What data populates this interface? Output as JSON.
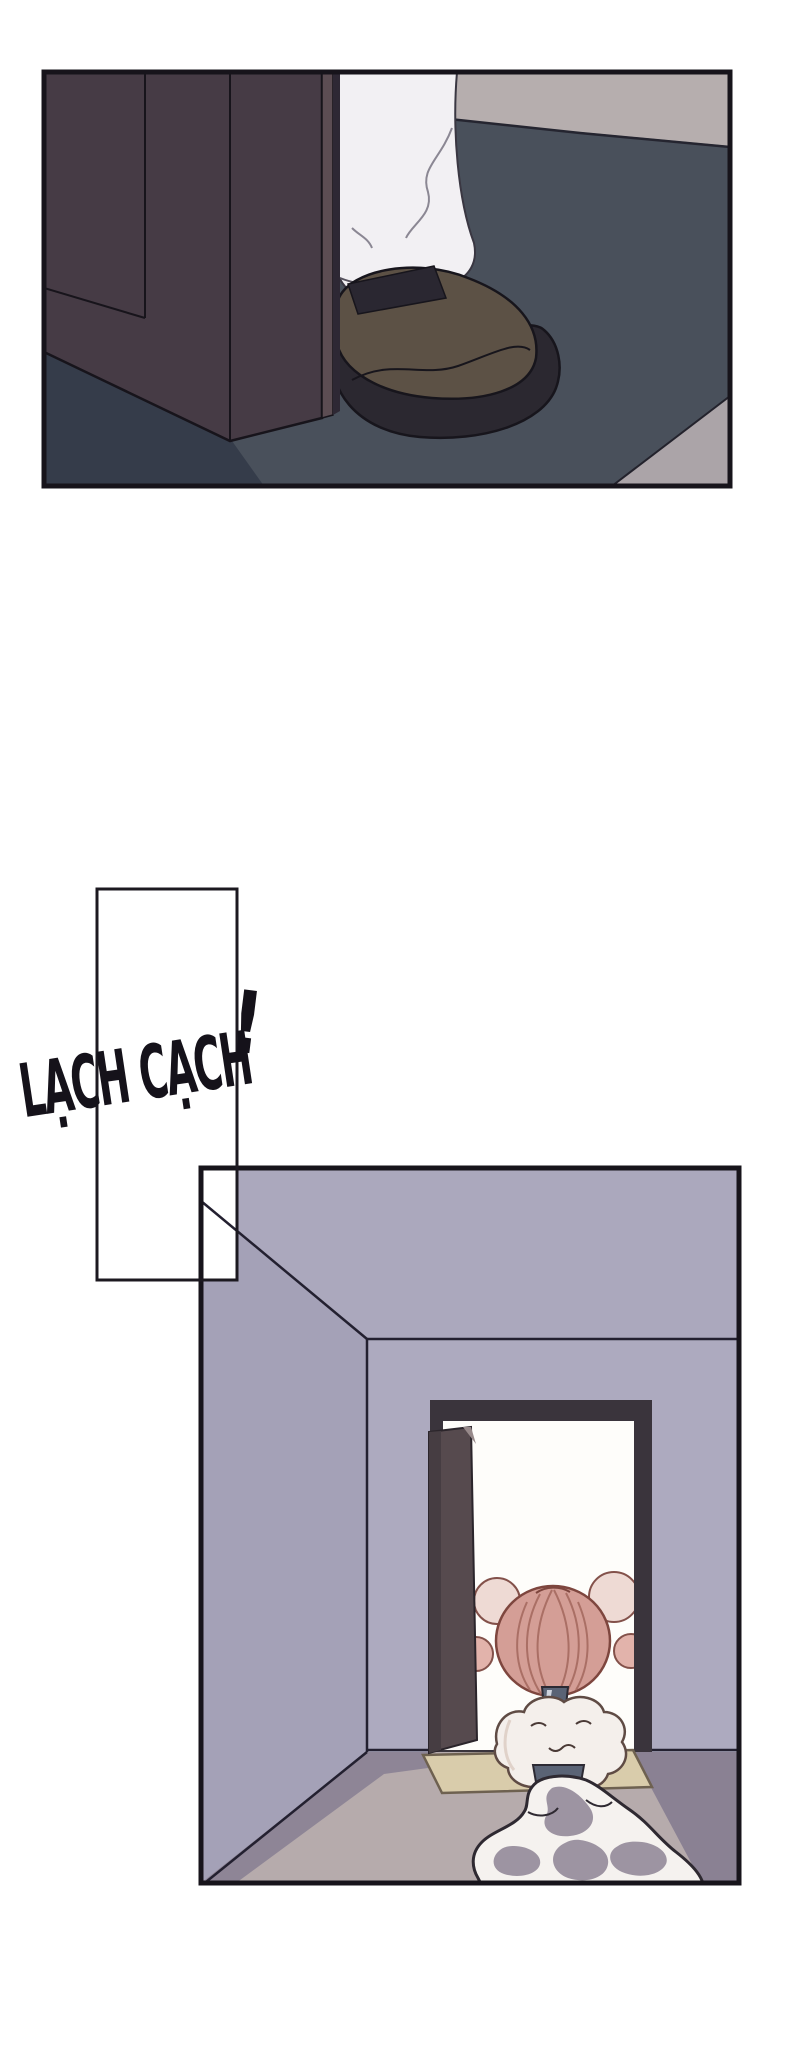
{
  "page": {
    "kind": "comic-page",
    "sfx": {
      "text": "LẠCH CẠCH",
      "bang": "!"
    }
  },
  "panels": {
    "top": {
      "alt": "Close-up of a shoe and white pant leg stepping past a dark wardrobe door onto a dark mat"
    },
    "speech": {
      "alt": "Empty tall rectangular panel behind the sound-effect text"
    },
    "bottom": {
      "alt": "Room interior with an open doorway; a small pink-haired figure sits in the doorway with a liquid trail flowing onto the floor"
    }
  },
  "palette": {
    "ink": "#17141b",
    "line": "#232030",
    "top_bg": "#b6aeae",
    "top_mat": "#49505b",
    "top_mat_dark": "#353c4a",
    "top_corner": "#aba4a8",
    "closet_door": "#463b45",
    "closet_door_edge": "#5c4d53",
    "closet_door_gap": "#2e2834",
    "pants": "#f2f0f3",
    "fold_line": "#8b8793",
    "shoe": "#5c5145",
    "shoe_sole": "#2b2830",
    "shoe_opening": "#2a2731",
    "ceiling": "#aba8bd",
    "left_wall": "#a4a1b7",
    "front_wall": "#adaabf",
    "door_frame": "#3a343c",
    "opening": "#fefdfa",
    "open_door": "#564a4e",
    "open_door_shade": "#463d42",
    "open_door_notch": "#97898a",
    "floor": "#b6abac",
    "floor_shadow": "#8e8596",
    "floor_dark": "#8a8193",
    "doormat": "#d9ccab",
    "hair": "#d49e96",
    "hair_outline": "#7e463e",
    "hair_strand": "#aa6f65",
    "puff": "#eedad4",
    "puff_dark": "#e2b3ab",
    "tie": "#5a6375",
    "towel": "#f4efeb",
    "towel_outline": "#5f4b44",
    "puddle": "#f5f2ef",
    "puddle_gray": "#9d94a2",
    "white": "#ffffff",
    "sfx_ink": "#15121a"
  }
}
